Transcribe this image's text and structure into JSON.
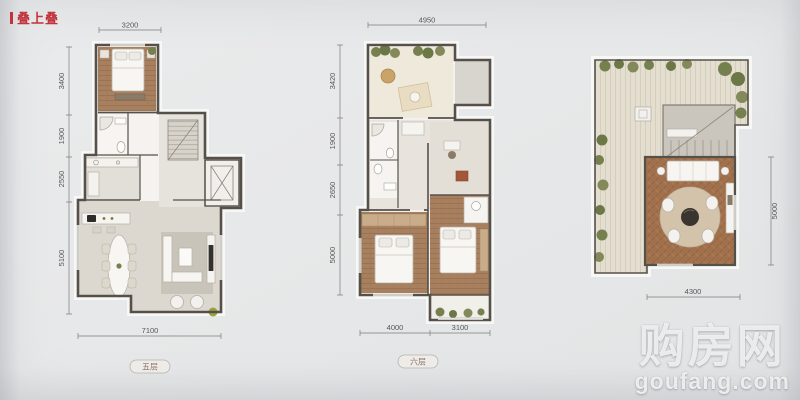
{
  "header": {
    "label": "叠上叠"
  },
  "plans": [
    {
      "label": "五层",
      "dims": {
        "top": [
          "3200"
        ],
        "left": [
          "3400",
          "1900",
          "2550",
          "5100"
        ],
        "bottom": [
          "7100"
        ],
        "right": []
      }
    },
    {
      "label": "六层",
      "dims": {
        "top": [
          "4950"
        ],
        "left": [
          "3420",
          "1900",
          "2650",
          "5000"
        ],
        "bottom": [
          "4000",
          "3100"
        ],
        "right": []
      }
    },
    {
      "label": "",
      "dims": {
        "top": [],
        "left": [],
        "bottom": [
          "4300"
        ],
        "right": [
          "5000"
        ]
      }
    }
  ],
  "watermark": {
    "site_name": "购房网",
    "site_url": "goufang.com"
  },
  "colors": {
    "accent_red": "#c2333d",
    "wall": "#56504a",
    "wood_floor": "#a8805f",
    "deck": "#e3decf",
    "plant_green": "#76804e"
  }
}
